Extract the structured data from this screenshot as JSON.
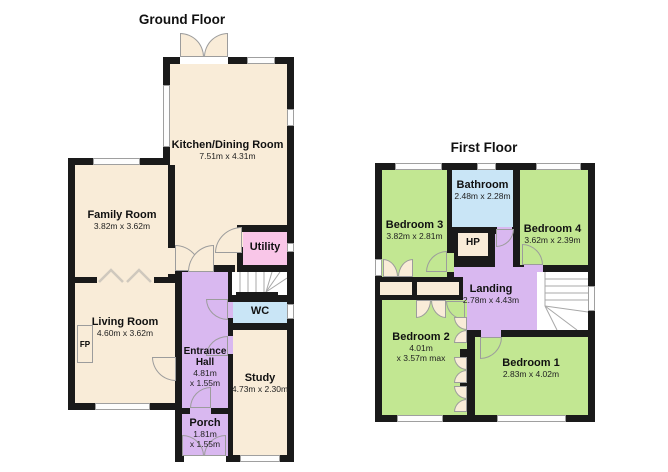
{
  "titles": {
    "ground": "Ground Floor",
    "first": "First Floor"
  },
  "colors": {
    "wall": "#1a1a1a",
    "cream": "#f9ecd8",
    "purple": "#d9b8f0",
    "pink": "#f9c6e8",
    "blue": "#c9e5f6",
    "green": "#c2e792",
    "window": "#fdfdfd"
  },
  "ground": {
    "rooms": {
      "kitchen": {
        "name": "Kitchen/Dining Room",
        "dims": "7.51m x 4.31m"
      },
      "family": {
        "name": "Family Room",
        "dims": "3.82m x 3.62m"
      },
      "living": {
        "name": "Living Room",
        "dims": "4.60m x 3.62m"
      },
      "hall": {
        "name": "Entrance Hall",
        "dims": "4.81m",
        "dims2": "x 1.55m"
      },
      "porch": {
        "name": "Porch",
        "dims": "1.81m",
        "dims2": "x 1.55m"
      },
      "study": {
        "name": "Study",
        "dims": "4.73m x 2.30m"
      },
      "utility": {
        "name": "Utility"
      },
      "wc": {
        "name": "WC"
      },
      "fireplace": {
        "name": "FP"
      }
    }
  },
  "first": {
    "rooms": {
      "bed3": {
        "name": "Bedroom 3",
        "dims": "3.82m x 2.81m"
      },
      "bathroom": {
        "name": "Bathroom",
        "dims": "2.48m x 2.28m"
      },
      "bed4": {
        "name": "Bedroom 4",
        "dims": "3.62m x 2.39m"
      },
      "hp": {
        "name": "HP"
      },
      "landing": {
        "name": "Landing",
        "dims": "2.78m x 4.43m"
      },
      "bed2": {
        "name": "Bedroom 2",
        "dims": "4.01m",
        "dims2": "x 3.57m max"
      },
      "bed1": {
        "name": "Bedroom 1",
        "dims": "2.83m x 4.02m"
      }
    }
  }
}
